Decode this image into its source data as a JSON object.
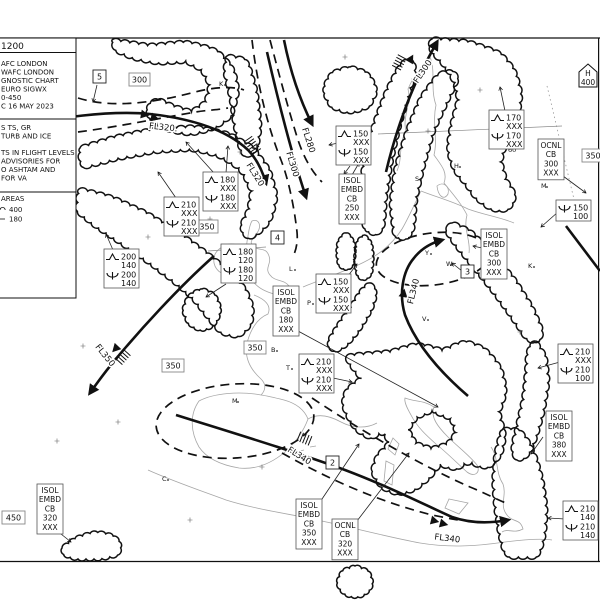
{
  "legend": {
    "title": "1200",
    "header": [
      "AFC LONDON",
      "WAFC LONDON",
      "GNOSTIC CHART",
      "EURO SIGWX",
      "0-450",
      "C 16 MAY 2023"
    ],
    "cb_note": [
      "S TS, GR",
      "TURB AND ICE"
    ],
    "heights_note": [
      "TS IN FLIGHT LEVELS",
      "ADVISORIES FOR",
      "O ASHTAM AND",
      "FOR VA"
    ],
    "cb_areas": {
      "label": "AREAS",
      "top": "400",
      "base": "180"
    }
  },
  "graticule": {
    "lat_label": "60"
  },
  "tropopause_high": {
    "letter": "H",
    "value": "400",
    "x": 588,
    "y": 77
  },
  "jet_labels": [
    {
      "text": "FL320.",
      "x": 163,
      "y": 130,
      "rot": 6
    },
    {
      "text": "FL320",
      "x": 253,
      "y": 176,
      "rot": 58
    },
    {
      "text": "FL280",
      "x": 306,
      "y": 141,
      "rot": 72
    },
    {
      "text": "FL300",
      "x": 290,
      "y": 165,
      "rot": 73
    },
    {
      "text": "FL300",
      "x": 425,
      "y": 73,
      "rot": -56
    },
    {
      "text": "FL340",
      "x": 416,
      "y": 292,
      "rot": -76
    },
    {
      "text": "FL350",
      "x": 103,
      "y": 357,
      "rot": 51
    },
    {
      "text": "FL340",
      "x": 298,
      "y": 458,
      "rot": 32
    },
    {
      "text": "FL340",
      "x": 447,
      "y": 541,
      "rot": 7
    }
  ],
  "fl_boxes": [
    {
      "text": "5",
      "x": 93,
      "y": 70,
      "w": 13,
      "h": 13,
      "style": "dark"
    },
    {
      "text": "300",
      "x": 129,
      "y": 73,
      "w": 21,
      "h": 13,
      "style": "gray"
    },
    {
      "text": "350",
      "x": 196,
      "y": 220,
      "w": 22,
      "h": 13,
      "style": "gray"
    },
    {
      "text": "350",
      "x": 162,
      "y": 359,
      "w": 22,
      "h": 13,
      "style": "gray"
    },
    {
      "text": "350",
      "x": 244,
      "y": 341,
      "w": 22,
      "h": 13,
      "style": "gray"
    },
    {
      "text": "350",
      "x": 582,
      "y": 149,
      "w": 22,
      "h": 13,
      "style": "gray"
    },
    {
      "text": "4",
      "x": 271,
      "y": 231,
      "w": 13,
      "h": 13,
      "style": "dark"
    },
    {
      "text": "3",
      "x": 461,
      "y": 265,
      "w": 13,
      "h": 13,
      "style": "dark"
    },
    {
      "text": "2",
      "x": 326,
      "y": 456,
      "w": 13,
      "h": 13,
      "style": "dark"
    },
    {
      "text": "450",
      "x": 2,
      "y": 511,
      "w": 23,
      "h": 13,
      "style": "gray"
    }
  ],
  "turb_boxes": [
    {
      "x": 203,
      "y": 172,
      "rows": [
        [
          "turb",
          "180",
          "XXX"
        ],
        [
          "ice",
          "180",
          "XXX"
        ]
      ]
    },
    {
      "x": 164,
      "y": 197,
      "rows": [
        [
          "turb",
          "210",
          "XXX"
        ],
        [
          "ice",
          "210",
          "XXX"
        ]
      ]
    },
    {
      "x": 104,
      "y": 249,
      "rows": [
        [
          "turb",
          "200",
          "140"
        ],
        [
          "ice",
          "200",
          "140"
        ]
      ]
    },
    {
      "x": 221,
      "y": 244,
      "rows": [
        [
          "turb",
          "180",
          "120"
        ],
        [
          "ice",
          "180",
          "120"
        ]
      ]
    },
    {
      "x": 336,
      "y": 126,
      "rows": [
        [
          "turb",
          "150",
          "XXX"
        ],
        [
          "ice",
          "150",
          "XXX"
        ]
      ]
    },
    {
      "x": 316,
      "y": 274,
      "rows": [
        [
          "turb",
          "150",
          "XXX"
        ],
        [
          "ice",
          "150",
          "XXX"
        ]
      ]
    },
    {
      "x": 299,
      "y": 354,
      "rows": [
        [
          "turb",
          "210",
          "XXX"
        ],
        [
          "ice",
          "210",
          "XXX"
        ]
      ]
    },
    {
      "x": 489,
      "y": 110,
      "rows": [
        [
          "turb",
          "170",
          "XXX"
        ],
        [
          "ice",
          "170",
          "XXX"
        ]
      ]
    },
    {
      "x": 558,
      "y": 344,
      "rows": [
        [
          "turb",
          "210",
          "XXX"
        ],
        [
          "ice",
          "210",
          "100"
        ]
      ]
    },
    {
      "x": 563,
      "y": 501,
      "rows": [
        [
          "turb",
          "210",
          "140"
        ],
        [
          "ice",
          "210",
          "140"
        ]
      ]
    },
    {
      "x": 556,
      "y": 200,
      "rows": [
        [
          "ice",
          "150",
          "100"
        ]
      ]
    }
  ],
  "cb_boxes": [
    {
      "x": 339,
      "y": 174,
      "lines": [
        "ISOL",
        "EMBD",
        "CB",
        "250",
        "XXX"
      ]
    },
    {
      "x": 273,
      "y": 286,
      "lines": [
        "ISOL",
        "EMBD",
        "CB",
        "180",
        "XXX"
      ]
    },
    {
      "x": 481,
      "y": 229,
      "lines": [
        "ISOL",
        "EMBD",
        "CB",
        "300",
        "XXX"
      ]
    },
    {
      "x": 538,
      "y": 139,
      "lines": [
        "OCNL",
        "CB",
        "300",
        "XXX"
      ]
    },
    {
      "x": 546,
      "y": 411,
      "lines": [
        "ISOL",
        "EMBD",
        "CB",
        "380",
        "XXX"
      ]
    },
    {
      "x": 37,
      "y": 484,
      "lines": [
        "ISOL",
        "EMBD",
        "CB",
        "320",
        "XXX"
      ]
    },
    {
      "x": 296,
      "y": 499,
      "lines": [
        "ISOL",
        "EMBD",
        "CB",
        "350",
        "XXX"
      ]
    },
    {
      "x": 332,
      "y": 519,
      "lines": [
        "OCNL",
        "CB",
        "320",
        "XXX"
      ]
    }
  ],
  "cities": [
    {
      "t": "K",
      "x": 219,
      "y": 86
    },
    {
      "t": "S",
      "x": 415,
      "y": 181
    },
    {
      "t": "H",
      "x": 454,
      "y": 168
    },
    {
      "t": "M",
      "x": 541,
      "y": 188
    },
    {
      "t": "W",
      "x": 446,
      "y": 266
    },
    {
      "t": "K",
      "x": 528,
      "y": 268
    },
    {
      "t": "L",
      "x": 289,
      "y": 271
    },
    {
      "t": "P",
      "x": 307,
      "y": 305
    },
    {
      "t": "V",
      "x": 422,
      "y": 321
    },
    {
      "t": "Y",
      "x": 425,
      "y": 255
    },
    {
      "t": "T",
      "x": 286,
      "y": 370
    },
    {
      "t": "B",
      "x": 271,
      "y": 352
    },
    {
      "t": "M",
      "x": 232,
      "y": 403
    },
    {
      "t": "C",
      "x": 162,
      "y": 481
    }
  ]
}
